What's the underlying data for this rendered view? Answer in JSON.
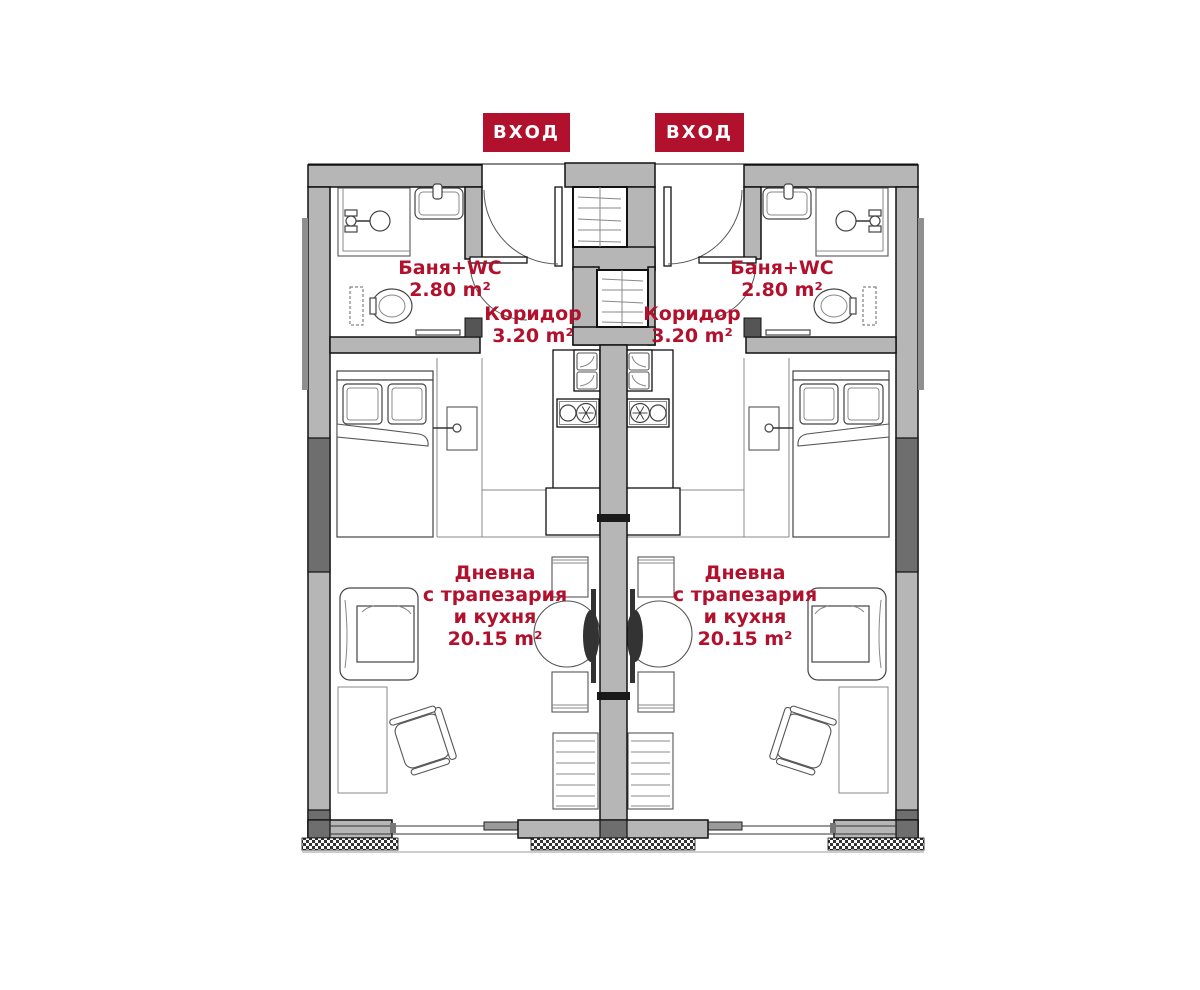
{
  "badges": {
    "entrance": "ВХОД"
  },
  "rooms": {
    "bath": {
      "name": "Баня+WC",
      "area": "2.80 m²"
    },
    "corridor": {
      "name": "Коридор",
      "area": "3.20 m²"
    },
    "living": {
      "name_line1": "Дневна",
      "name_line2": "с трапезария",
      "name_line3": "и кухня",
      "area": "20.15 m²"
    }
  },
  "colors": {
    "accent_red": "#b2112d",
    "wall_gray": "#b6b6b6",
    "wall_dark": "#6e6e6e",
    "outline": "#111111"
  }
}
